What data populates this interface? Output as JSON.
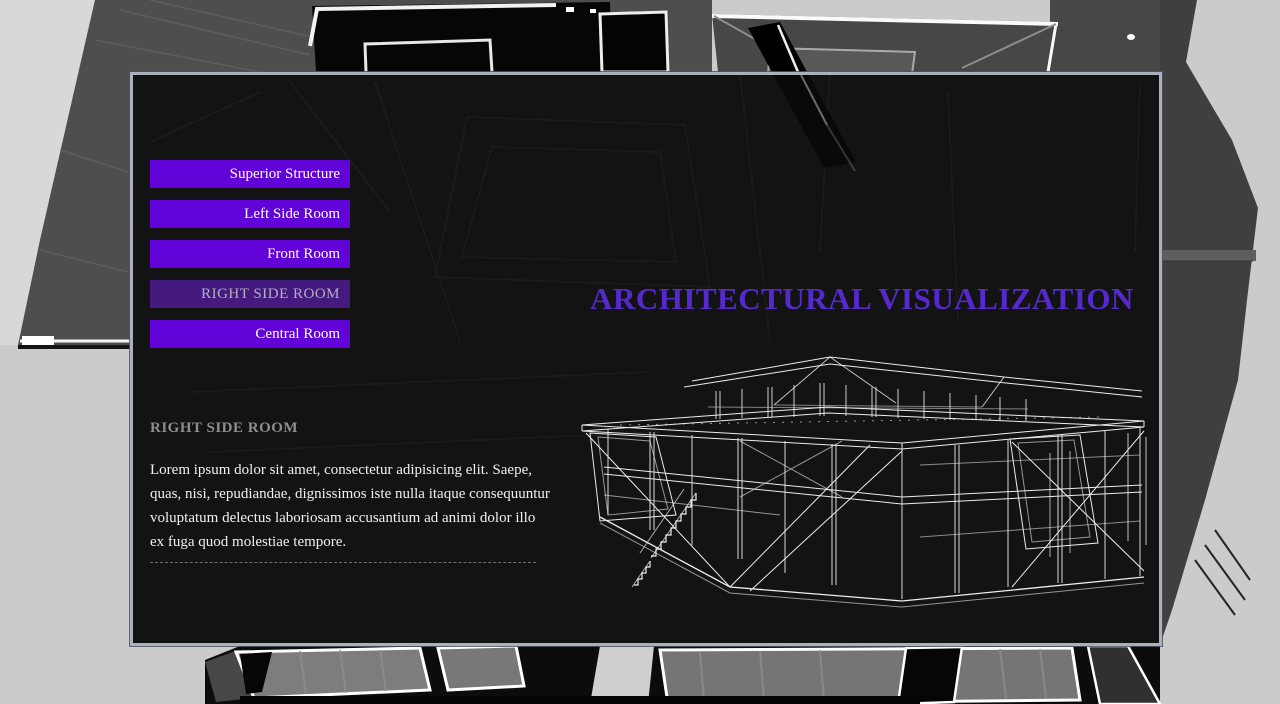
{
  "title": "ARCHITECTURAL VISUALIZATION",
  "nav": {
    "items": [
      {
        "label": "Superior Structure",
        "active": false
      },
      {
        "label": "Left Side Room",
        "active": false
      },
      {
        "label": "Front Room",
        "active": false
      },
      {
        "label": "RIGHT SIDE ROOM",
        "active": true
      },
      {
        "label": "Central Room",
        "active": false
      }
    ]
  },
  "content": {
    "heading": "RIGHT SIDE ROOM",
    "body": "Lorem ipsum dolor sit amet, consectetur adipisicing elit. Saepe, quas, nisi, repudiandae, dignissimos iste nulla itaque consequuntur voluptatum delectus laboriosam accusantium ad animi dolor illo ex fuga quod molestiae tempore."
  },
  "illustration": {
    "name": "wireframe-house"
  },
  "colors": {
    "button_bg": "#6103d8",
    "button_active_bg": "#451a7e",
    "button_text": "#ffffff",
    "button_active_text": "#b5aec2",
    "title_text": "#5629cf",
    "heading_text": "#8e8e8e",
    "body_text": "#f0f0f0",
    "panel_border": "#aab0bc",
    "page_background": "#cdcdcd"
  }
}
